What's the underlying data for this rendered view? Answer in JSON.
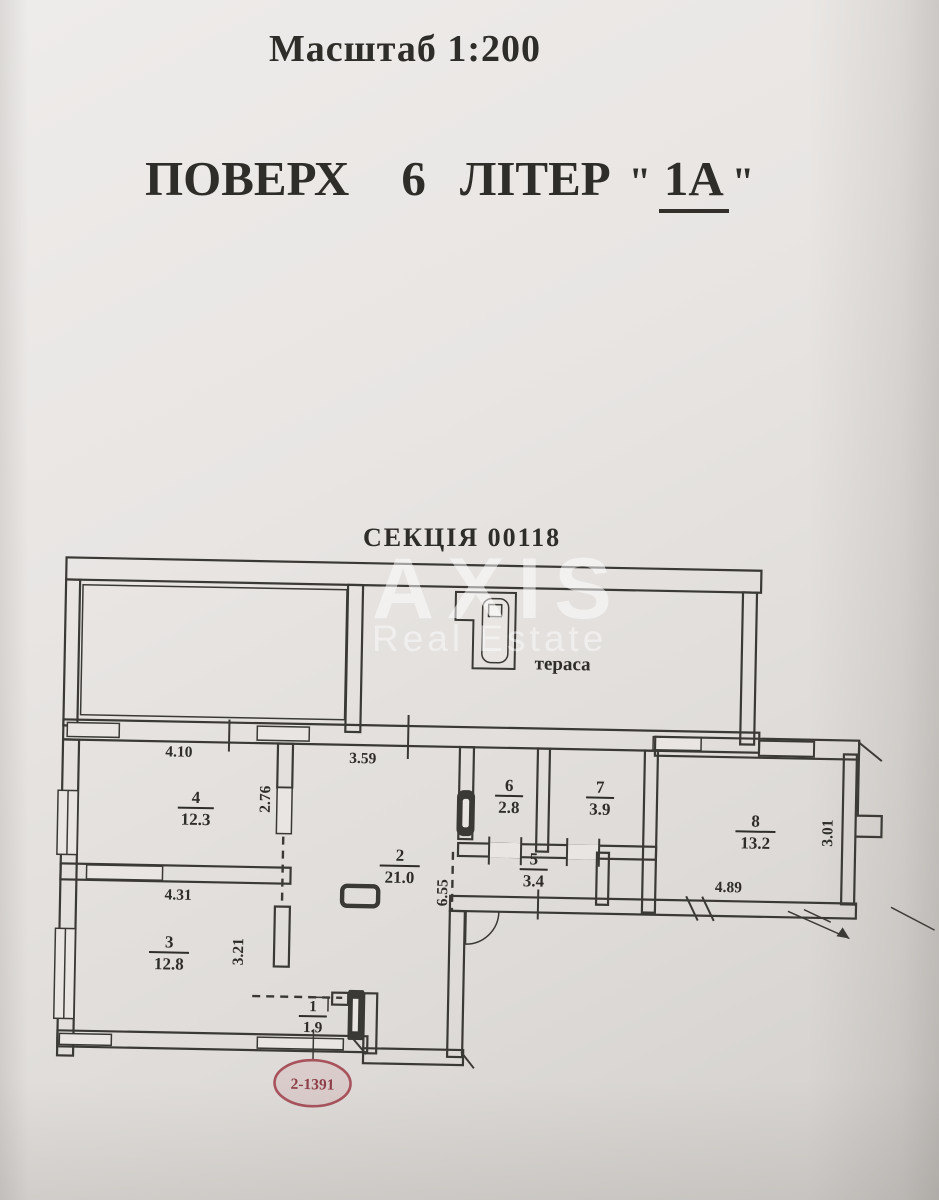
{
  "document": {
    "scale_label": "Масштаб 1:200",
    "floor_label": {
      "word_floor": "ПОВЕРХ",
      "number": "6",
      "word_letter": "ЛІТЕР",
      "open_quote": "\"",
      "value": "1А",
      "close_quote": "\""
    },
    "section_label": "СЕКЦІЯ 00118"
  },
  "watermark": {
    "line1": "AXIS",
    "line2": "Real Estate"
  },
  "plan": {
    "terrace_label": "тераса",
    "stamp_code": "2-1391",
    "rooms": [
      {
        "number": "4",
        "area": "12.3"
      },
      {
        "number": "2",
        "area": "21.0"
      },
      {
        "number": "6",
        "area": "2.8"
      },
      {
        "number": "7",
        "area": "3.9"
      },
      {
        "number": "5",
        "area": "3.4"
      },
      {
        "number": "8",
        "area": "13.2"
      },
      {
        "number": "3",
        "area": "12.8"
      },
      {
        "number": "1",
        "area": "1.9"
      }
    ],
    "dimensions": {
      "room4_width": "4.10",
      "terrace_step": "3.59",
      "room4_depth": "2.76",
      "room3_width": "4.31",
      "room3_depth": "3.21",
      "hall_length": "6.55",
      "room8_width": "4.89",
      "room8_depth": "3.01"
    }
  },
  "colors": {
    "paper": "#e8e5e2",
    "ink": "#3b3935",
    "stamp": "#a8525c"
  }
}
